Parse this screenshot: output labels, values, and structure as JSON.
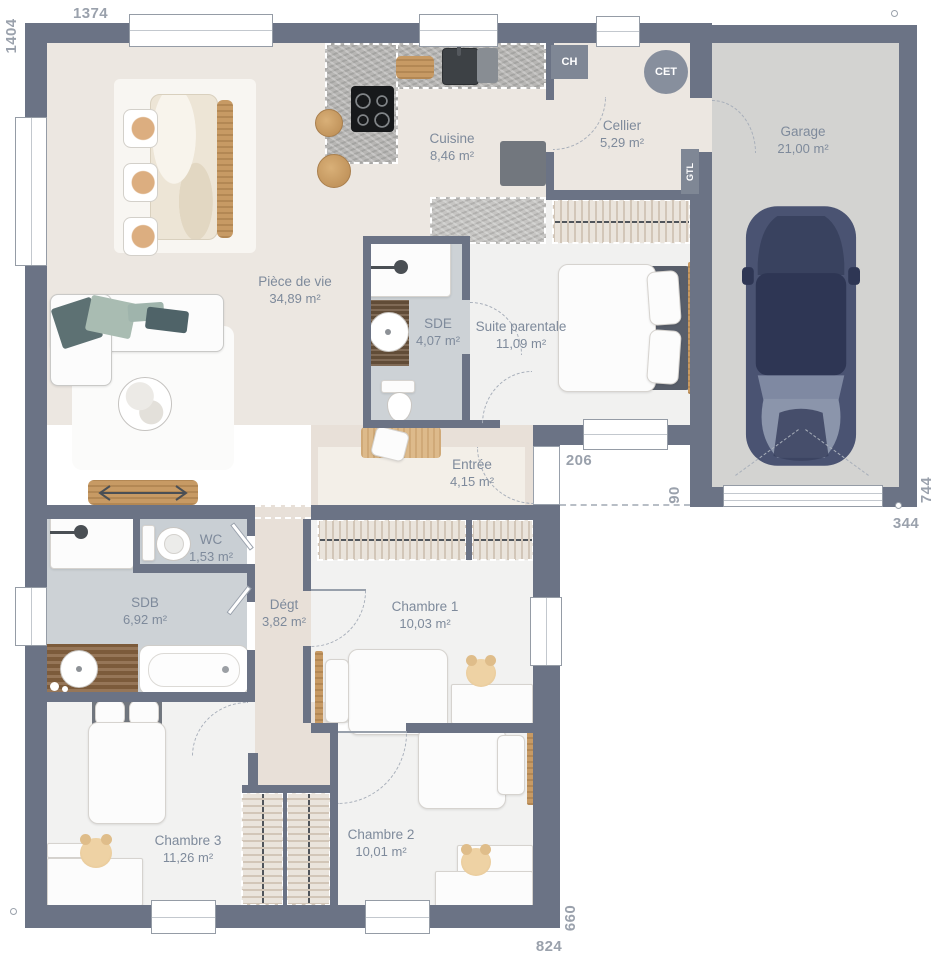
{
  "plan": {
    "rooms": {
      "piece_de_vie": {
        "name": "Pièce de vie",
        "area": "34,89 m²"
      },
      "cuisine": {
        "name": "Cuisine",
        "area": "8,46 m²"
      },
      "cellier": {
        "name": "Cellier",
        "area": "5,29 m²"
      },
      "garage": {
        "name": "Garage",
        "area": "21,00 m²"
      },
      "sde": {
        "name": "SDE",
        "area": "4,07 m²"
      },
      "suite_parentale": {
        "name": "Suite parentale",
        "area": "11,09 m²"
      },
      "entree": {
        "name": "Entrée",
        "area": "4,15 m²"
      },
      "wc": {
        "name": "WC",
        "area": "1,53 m²"
      },
      "sdb": {
        "name": "SDB",
        "area": "6,92 m²"
      },
      "degagement": {
        "name": "Dégt",
        "area": "3,82 m²"
      },
      "chambre1": {
        "name": "Chambre 1",
        "area": "10,03 m²"
      },
      "chambre2": {
        "name": "Chambre 2",
        "area": "10,01 m²"
      },
      "chambre3": {
        "name": "Chambre 3",
        "area": "11,26 m²"
      }
    },
    "equipment": {
      "boiler": "CH",
      "water_heater": "CET",
      "electrical_column": "GTL"
    },
    "dimensions": {
      "top_width": "1374",
      "left_height": "1404",
      "porch_width": "206",
      "porch_depth": "90",
      "garage_side": "744",
      "garage_width": "344",
      "right_side": "660",
      "bottom_width": "824"
    },
    "colors": {
      "wall": "#6b7385",
      "floor_main": "#ece7e1",
      "floor_bedroom": "#f2f2f1",
      "floor_wet": "#cdd2d6",
      "floor_garage": "#d3d3d1",
      "wood": "#c79a64",
      "label_text": "#7e8a9b",
      "dimension_text": "#9aa1ac"
    }
  }
}
